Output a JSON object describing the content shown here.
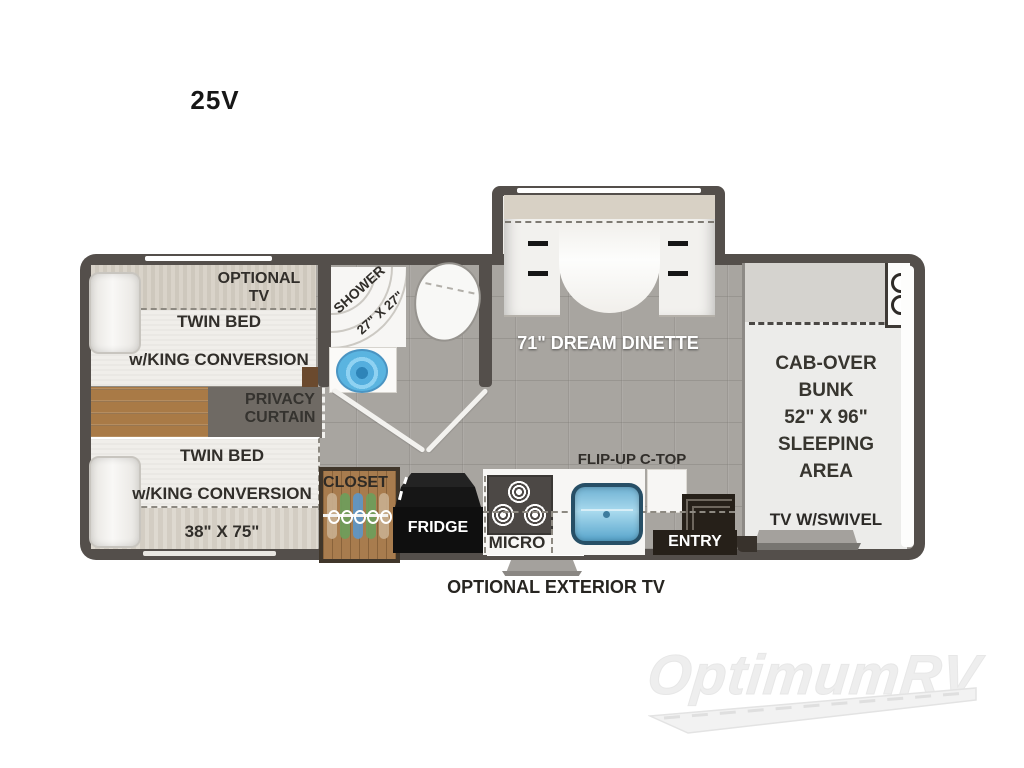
{
  "title": "25V",
  "floorplan": {
    "bedroom": {
      "optional_tv": "OPTIONAL\nTV",
      "rear_bed": {
        "line1": "TWIN BED",
        "line2": "w/KING CONVERSION",
        "line3": "38\" X 75\""
      },
      "front_bed": {
        "line1": "TWIN BED",
        "line2": "w/KING CONVERSION",
        "line3": "38\" X 75\""
      },
      "privacy": "PRIVACY\nCURTAIN"
    },
    "bathroom": {
      "shower_line1": "SHOWER",
      "shower_line2": "27\" X 27\""
    },
    "dinette_label": "71\" DREAM DINETTE",
    "kitchen": {
      "closet": "CLOSET",
      "fridge": "FRIDGE",
      "micro": "MICRO",
      "flip_up": "FLIP-UP C-TOP",
      "entry": "ENTRY"
    },
    "cab": {
      "bunk": "CAB-OVER\nBUNK\n52\" X 96\"\nSLEEPING\nAREA",
      "tv": "TV W/SWIVEL"
    },
    "exterior_tv_label": "OPTIONAL EXTERIOR TV"
  },
  "watermark": "OptimumRV",
  "colors": {
    "wall": "#544f4b",
    "floor_tile": "#a8a5a0",
    "wood": "#a87c4e",
    "sink_blue": "#5ab4e0",
    "label_dark": "#312e2a"
  }
}
